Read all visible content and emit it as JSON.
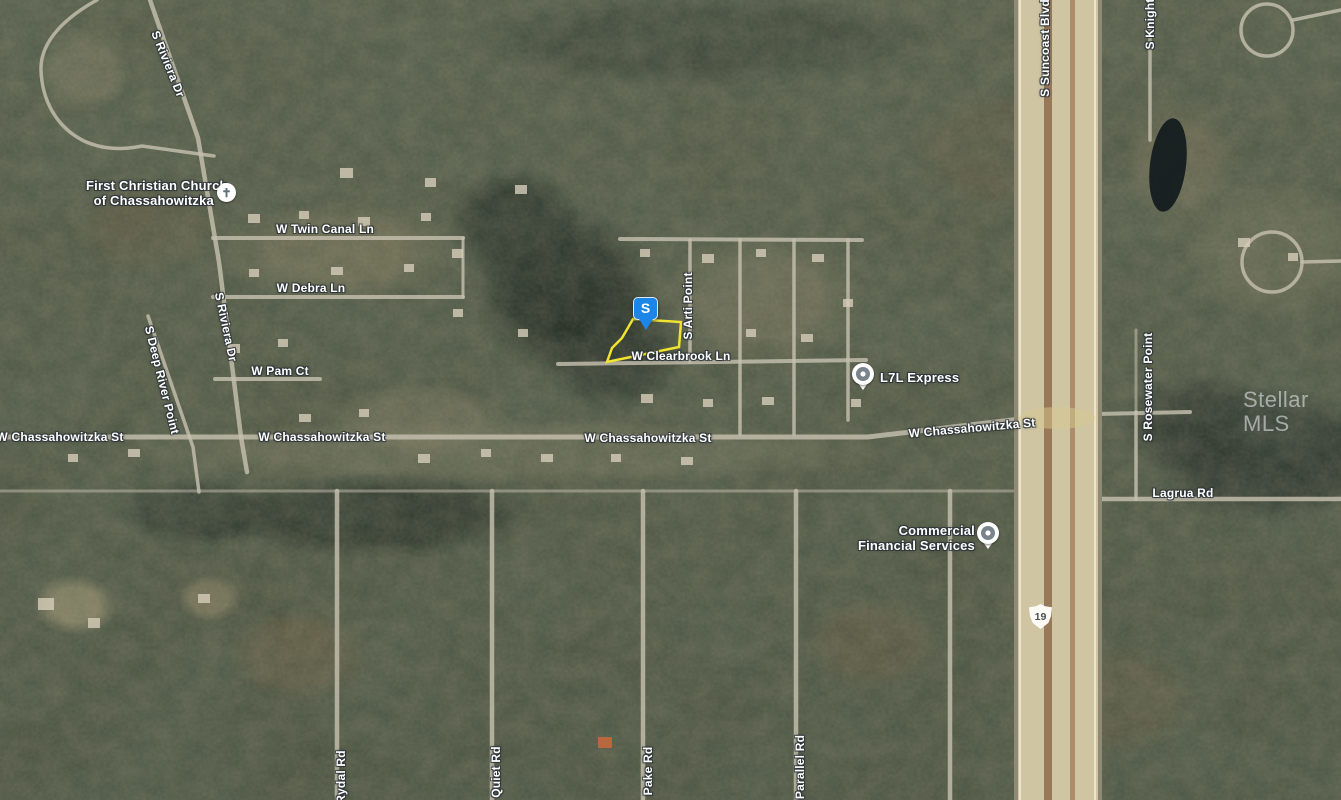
{
  "watermark": "Stellar MLS",
  "icons": {
    "church": "✝"
  },
  "subject_marker": {
    "label": "S",
    "color": "#1c86e8"
  },
  "parcel": {
    "outline_color": "#f2e32e"
  },
  "route_shield": {
    "number": "19"
  },
  "pois": {
    "church": {
      "line1": "First Christian Church",
      "line2": "of Chassahowitzka"
    },
    "l7l": {
      "name": "L7L Express"
    },
    "cfs": {
      "line1": "Commercial",
      "line2": "Financial Services"
    }
  },
  "road_labels": {
    "twin_canal": "W Twin Canal Ln",
    "debra": "W Debra Ln",
    "pam": "W Pam Ct",
    "clearbrook": "W Clearbrook Ln",
    "chass_1": "W Chassahowitzka St",
    "chass_2": "W Chassahowitzka St",
    "chass_3": "W Chassahowitzka St",
    "chass_4": "W Chassahowitzka St",
    "riviera_top": "S Riviera Dr",
    "riviera_mid": "S Riviera Dr",
    "deep_river": "S Deep River Point",
    "arti": "S Arti Point",
    "suncoast": "S Suncoast Blvd",
    "rosewater": "S Rosewater Point",
    "knight": "S Knight",
    "lagrua": "Lagrua Rd",
    "rydal": "Rydal Rd",
    "quiet": "Quiet Rd",
    "pake": "Pake Rd",
    "parallel": "Parallel Rd"
  }
}
